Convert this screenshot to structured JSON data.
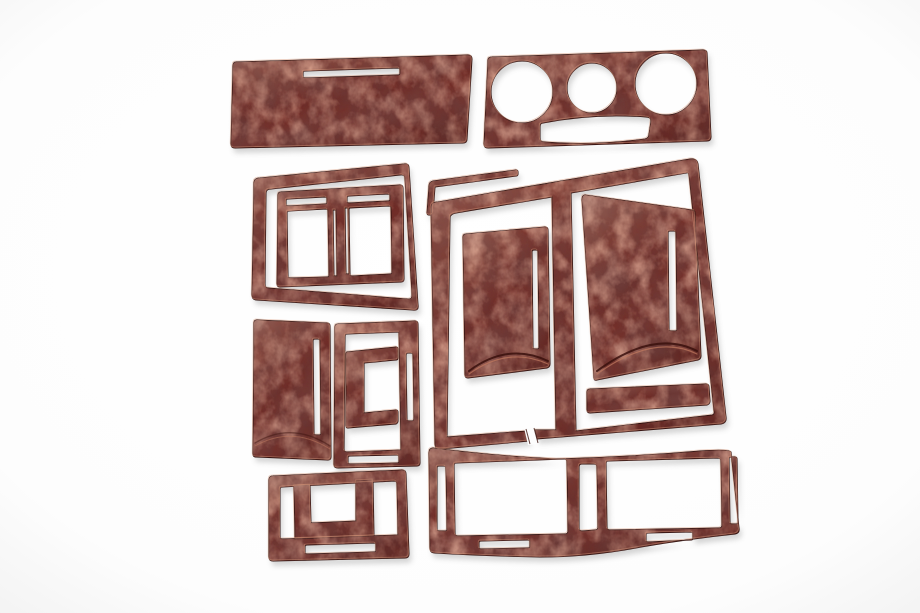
{
  "scene": {
    "type": "product-photo",
    "description": "Product photo of a 15-piece glossy dark-red burl wood car dashboard interior trim kit laid out on a plain white background",
    "background_color": "#fdfdfd",
    "piece_count": 15,
    "material": {
      "finish": "high-gloss red burl wood",
      "base_color": "#702a24",
      "dark_marble_color": "#2f0d0a",
      "light_marble_color": "#9a4f3b",
      "edge_highlight_color": "#d89a7c",
      "outline_color": "#2a0c09",
      "shadow_color": "#6b6b6b"
    },
    "pieces": [
      {
        "id": "upper-dash-panel",
        "label": "Wide upper dash panel with thin slot"
      },
      {
        "id": "climate-control-bezel",
        "label": "Bezel with three round dial cutouts and lower cutout"
      },
      {
        "id": "vent-surround-frame",
        "label": "Trapezoid vent surround outer frame"
      },
      {
        "id": "vent-bezel-insert",
        "label": "Twin-window air vent bezel with top slots"
      },
      {
        "id": "windshield-trim-strip",
        "label": "Thin angled trim strip"
      },
      {
        "id": "center-console-frame",
        "label": "Large two-window console frame with center divider and cut lower rail"
      },
      {
        "id": "door-panel-left",
        "label": "Door trim panel with vertical slot and curved recess"
      },
      {
        "id": "door-panel-right",
        "label": "Larger door trim panel with vertical slot and curved recess"
      },
      {
        "id": "lower-accent-bar",
        "label": "Small lower accent bar"
      },
      {
        "id": "side-panel",
        "label": "Solid side panel with vertical slot"
      },
      {
        "id": "shifter-surround",
        "label": "Shifter surround ring with side and bottom slots"
      },
      {
        "id": "shifter-gate-bracket",
        "label": "C-shaped shifter gate bracket"
      },
      {
        "id": "console-pocket-frame",
        "label": "Console pocket frame with bottom slot"
      },
      {
        "id": "pocket-bracket",
        "label": "U-shaped pocket bracket"
      },
      {
        "id": "lower-dash-fascia",
        "label": "Wide lower fascia with two windows and slot cutouts"
      }
    ]
  }
}
